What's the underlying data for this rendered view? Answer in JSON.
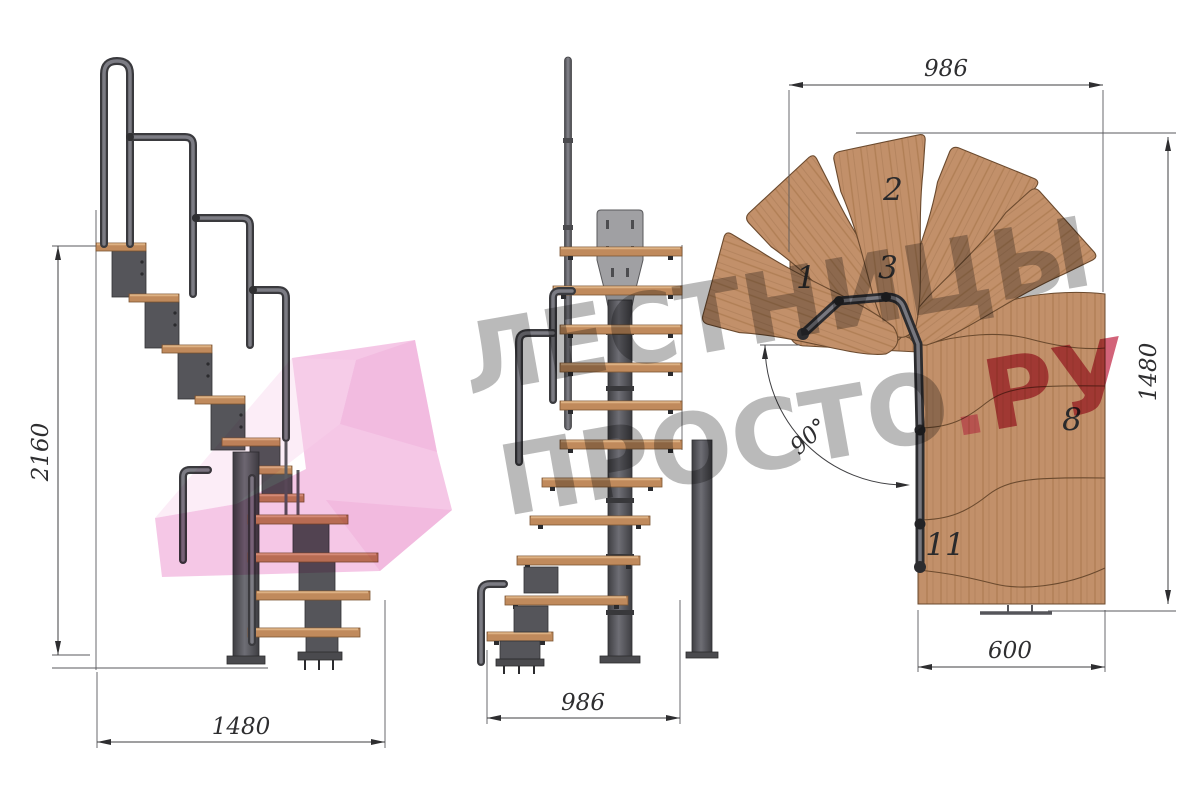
{
  "title": "Staircase dimensional drawing",
  "watermark": {
    "line1": "ЛЕСТНИЦЫ",
    "line2_gray": "ПРОСТО",
    "dot": ".",
    "line2_red": "РУ",
    "gray_color": "#7a7a7a",
    "red_color": "#c73c58",
    "pink_arrow_color": "#f4bfe2"
  },
  "views": {
    "side": {
      "label": "side elevation",
      "dim_height": "2160",
      "dim_width": "1480"
    },
    "front": {
      "label": "front elevation",
      "dim_width": "986"
    },
    "plan": {
      "label": "plan view",
      "dim_top": "986",
      "dim_right": "1480",
      "dim_bottom": "600",
      "angle": "90°",
      "step_labels": [
        "1",
        "2",
        "3",
        "8",
        "11"
      ]
    }
  },
  "colors": {
    "wood": "#c2906a",
    "wood_edge": "#6b4a2e",
    "metal_dark": "#3c3c3f",
    "metal_mid": "#5b5b60",
    "plate": "#a0a0a3",
    "dimension_lines": "#3f3f42"
  }
}
